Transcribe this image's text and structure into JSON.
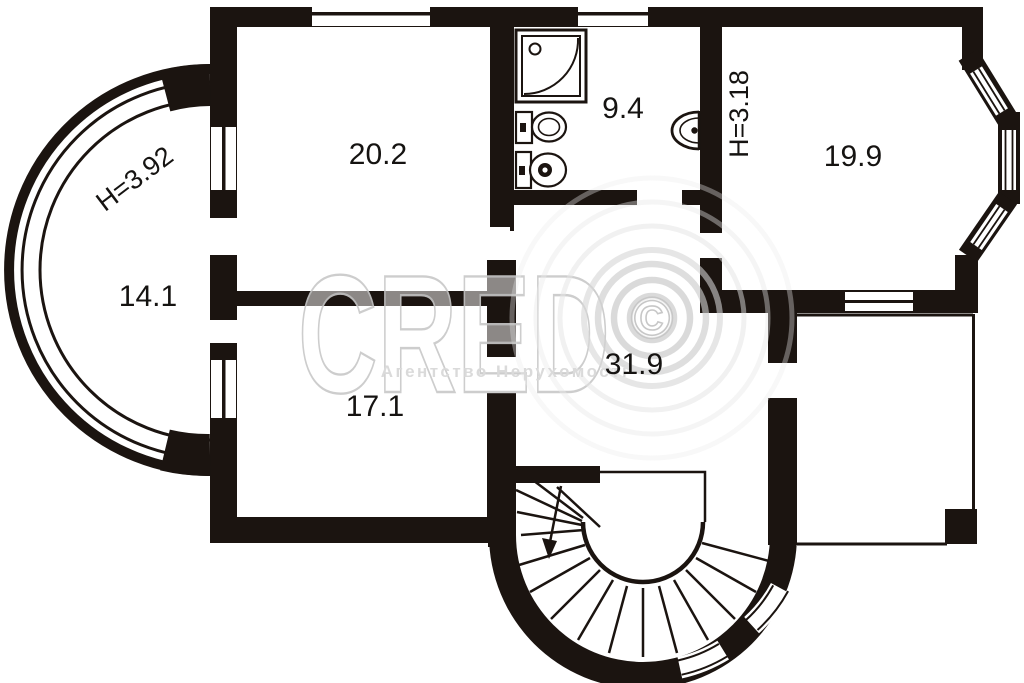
{
  "plan": {
    "title": "apartment floor plan",
    "rooms": [
      {
        "id": "room-top-left",
        "area": "20.2"
      },
      {
        "id": "bathroom",
        "area": "9.4"
      },
      {
        "id": "room-top-right",
        "area": "19.9",
        "ceiling_height": "H=3.18"
      },
      {
        "id": "bay-room-left",
        "area": "14.1",
        "ceiling_height": "H=3.92"
      },
      {
        "id": "room-mid-left",
        "area": "17.1"
      },
      {
        "id": "hall-center",
        "area": "31.9"
      }
    ]
  },
  "watermark": {
    "brand": "CRED",
    "symbol": "©",
    "agency_line": "Агентство Нерухомості"
  },
  "colors": {
    "wall": "#1b1410",
    "background": "#ffffff",
    "watermark_gray": "#d6d6d6"
  }
}
